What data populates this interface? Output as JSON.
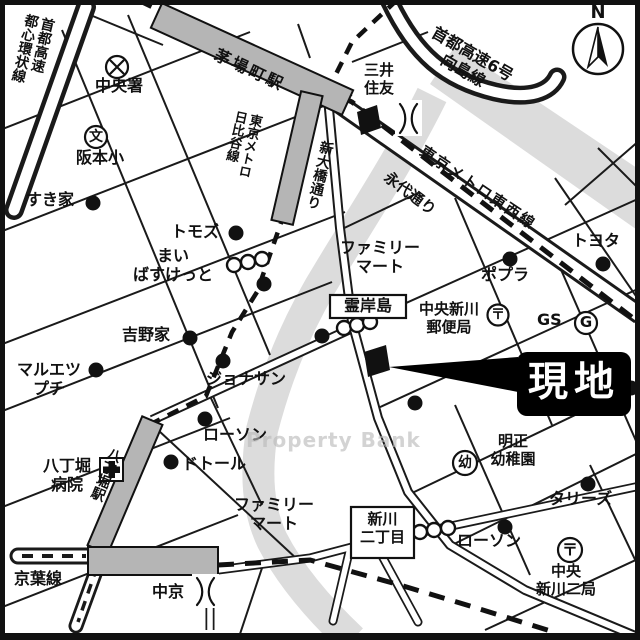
{
  "map_type": "japanese-real-estate-access-map",
  "colors": {
    "road_line": "#1a1a1a",
    "station_fill": "#b5b5b5",
    "river_fill": "#dcdcdc",
    "map_bg": "#ffffff",
    "site_callout_bg": "#000000",
    "site_callout_text": "#ffffff",
    "watermark_text": "#b9b9b9"
  },
  "site_marker": {
    "label": "現地"
  },
  "watermark": {
    "text": "Property Bank"
  },
  "compass": {
    "label": "N"
  },
  "stations": [
    "茅場町駅",
    "八丁堀駅"
  ],
  "rail_lines": [
    "東京メトロ日比谷線",
    "東京メトロ東西線",
    "京葉線"
  ],
  "roads": [
    "新大橋通り",
    "永代通り",
    "首都高速都心環状線",
    "首都高速6号向島線"
  ],
  "landmarks": [
    "中央署",
    "阪本小",
    "すき家",
    "三井住友",
    "トモズ",
    "まいばすけっと",
    "ファミリーマート",
    "ポプラ",
    "トヨタ",
    "霊岸島",
    "中央新川郵便局",
    "GS",
    "吉野家",
    "マルエツプチ",
    "ジョナサン",
    "ローソン",
    "ドトール",
    "八丁堀病院",
    "明正幼稚園",
    "タリーズ",
    "新川二丁目",
    "中央新川二局",
    "中京"
  ],
  "labels": [
    {
      "id": "shuto-tl",
      "text": "首都高速\n都心環状線",
      "x": 24,
      "y": 12,
      "size": 14,
      "rot": 13,
      "v": true
    },
    {
      "id": "chuo-police",
      "text": "中央署",
      "x": 95,
      "y": 77,
      "size": 16
    },
    {
      "id": "sakamoto-elem",
      "text": "阪本小",
      "x": 76,
      "y": 149,
      "size": 16
    },
    {
      "id": "sukiya",
      "text": "すき家",
      "x": 26,
      "y": 191,
      "size": 16
    },
    {
      "id": "kayabacho-sta",
      "text": "茅場町駅",
      "x": 219,
      "y": 46,
      "size": 16,
      "rot": 25,
      "ls": 3
    },
    {
      "id": "hibiya-line",
      "text": "東京メトロ\n日比谷線",
      "x": 233,
      "y": 109,
      "size": 13,
      "rot": 12,
      "v": true
    },
    {
      "id": "shin-ohashi-dori",
      "text": "新大橋通り",
      "x": 319,
      "y": 139,
      "size": 14,
      "rot": 13,
      "v": true
    },
    {
      "id": "mitsui-sumitomo",
      "text": "三井\n住友",
      "x": 364,
      "y": 62,
      "size": 15
    },
    {
      "id": "shuto-6-mukojima",
      "text": "首都高速6号\n向島線",
      "x": 424,
      "y": 16,
      "size": 16,
      "rot": 30,
      "w": 122,
      "align": "center"
    },
    {
      "id": "tozai-line",
      "text": "東京メトロ東西線",
      "x": 426,
      "y": 143,
      "size": 15,
      "rot": 34,
      "ls": 2
    },
    {
      "id": "eitai-dori",
      "text": "永代通り",
      "x": 391,
      "y": 169,
      "size": 15,
      "rot": 37
    },
    {
      "id": "toyota",
      "text": "トヨタ",
      "x": 572,
      "y": 232,
      "size": 16
    },
    {
      "id": "tomods",
      "text": "トモズ",
      "x": 171,
      "y": 223,
      "size": 16
    },
    {
      "id": "my-basket",
      "text": "まい\nばすけっと",
      "x": 120,
      "y": 247,
      "size": 16,
      "w": 106,
      "align": "center"
    },
    {
      "id": "familymart-1",
      "text": "ファミリー\nマート",
      "x": 330,
      "y": 239,
      "size": 16,
      "w": 100,
      "align": "center"
    },
    {
      "id": "poplar",
      "text": "ポプラ",
      "x": 481,
      "y": 266,
      "size": 16
    },
    {
      "id": "reiganjima",
      "text": "霊岸島",
      "x": 333,
      "y": 297,
      "size": 16,
      "w": 70,
      "align": "center"
    },
    {
      "id": "chuo-shinkawa-po",
      "text": "中央新川\n郵便局",
      "x": 406,
      "y": 301,
      "size": 15,
      "w": 86,
      "align": "center"
    },
    {
      "id": "gs",
      "text": "GS",
      "x": 537,
      "y": 311,
      "size": 16
    },
    {
      "id": "yoshinoya",
      "text": "吉野家",
      "x": 122,
      "y": 326,
      "size": 16
    },
    {
      "id": "maruetsu-petit",
      "text": "マルエツ\nプチ",
      "x": 8,
      "y": 361,
      "size": 16,
      "w": 82,
      "align": "center"
    },
    {
      "id": "jonathan",
      "text": "ジョナサン",
      "x": 206,
      "y": 370,
      "size": 16
    },
    {
      "id": "lawson-1",
      "text": "ローソン",
      "x": 203,
      "y": 426,
      "size": 16
    },
    {
      "id": "doutor",
      "text": "ドトール",
      "x": 182,
      "y": 455,
      "size": 16
    },
    {
      "id": "hatchobori-hosp",
      "text": "八丁堀\n病院",
      "x": 34,
      "y": 457,
      "size": 16,
      "w": 66,
      "align": "center"
    },
    {
      "id": "hatchobori-sta",
      "text": "八丁堀駅",
      "x": 108,
      "y": 445,
      "size": 14,
      "rot": 22,
      "v": true
    },
    {
      "id": "meisei-kinder",
      "text": "明正\n幼稚園",
      "x": 478,
      "y": 433,
      "size": 15,
      "w": 70,
      "align": "center"
    },
    {
      "id": "tullys",
      "text": "タリーズ",
      "x": 549,
      "y": 490,
      "size": 16
    },
    {
      "id": "familymart-2",
      "text": "ファミリー\nマート",
      "x": 226,
      "y": 496,
      "size": 16,
      "w": 96,
      "align": "center"
    },
    {
      "id": "shinkawa-2chome",
      "text": "新川\n二丁目",
      "x": 354,
      "y": 511,
      "size": 15,
      "w": 57,
      "align": "center"
    },
    {
      "id": "lawson-2",
      "text": "ローソン",
      "x": 457,
      "y": 532,
      "size": 16
    },
    {
      "id": "chuo-shinkawa-2po",
      "text": "中央\n新川二局",
      "x": 524,
      "y": 563,
      "size": 15,
      "w": 84,
      "align": "center"
    },
    {
      "id": "keiyo-line",
      "text": "京葉線",
      "x": 14,
      "y": 570,
      "size": 16
    },
    {
      "id": "chukyo",
      "text": "中京",
      "x": 152,
      "y": 583,
      "size": 16
    },
    {
      "id": "north-n",
      "text": "N",
      "x": 588,
      "y": 2,
      "size": 18,
      "w": 20,
      "align": "center"
    },
    {
      "id": "school-glyph",
      "text": "文",
      "x": 87,
      "y": 129,
      "size": 14,
      "w": 18,
      "align": "center"
    },
    {
      "id": "kinder-glyph",
      "text": "幼",
      "x": 455,
      "y": 455,
      "size": 14,
      "w": 20,
      "align": "center"
    },
    {
      "id": "post-glyph-1",
      "text": "〒",
      "x": 488,
      "y": 307,
      "size": 14,
      "w": 20,
      "align": "center"
    },
    {
      "id": "post-glyph-2",
      "text": "〒",
      "x": 559,
      "y": 541,
      "size": 16,
      "w": 22,
      "align": "center"
    },
    {
      "id": "gas-g-glyph",
      "text": "G",
      "x": 576,
      "y": 314,
      "size": 15,
      "w": 20,
      "align": "center"
    }
  ]
}
